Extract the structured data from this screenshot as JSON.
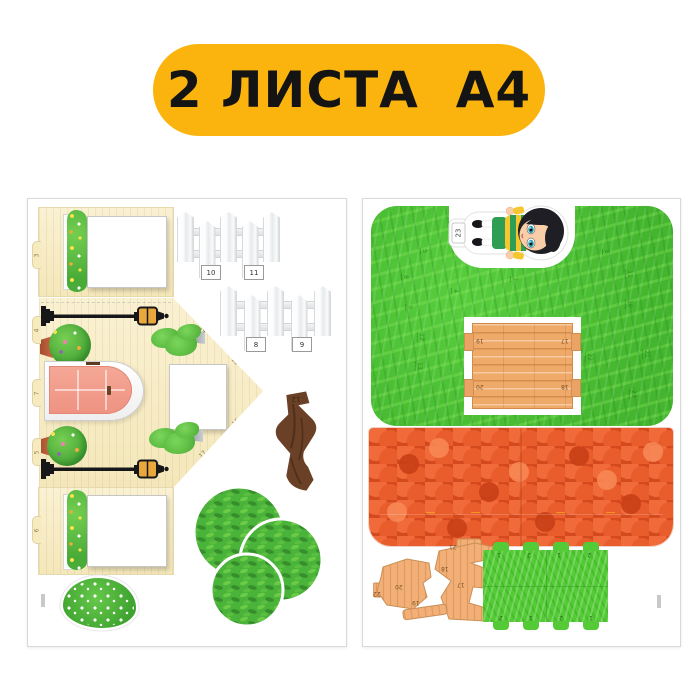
{
  "badge": {
    "label": "2 ЛИСТА  А4",
    "bg_color": "#FBB30D",
    "text_color": "#141414"
  },
  "palette": {
    "wall_cream": "#F8EDC6",
    "door_pink": "#F29A8B",
    "grass_green": "#4EC336",
    "roof_orange": "#E85A2B",
    "wood_tan": "#EFAA6A",
    "foliage_green": "#4AB33A",
    "lantern_amber": "#E9A83C",
    "trunk_brown": "#6A4026"
  },
  "sheet_left": {
    "edge_tabs": [
      {
        "label": "3"
      },
      {
        "label": "4"
      },
      {
        "label": "7"
      },
      {
        "label": "5"
      },
      {
        "label": "6"
      }
    ],
    "gable_tabs": [
      {
        "label": "14"
      },
      {
        "label": "15"
      },
      {
        "label": "16"
      },
      {
        "label": "17"
      }
    ],
    "fence_top_labels": [
      {
        "label": "10"
      },
      {
        "label": "11"
      }
    ],
    "fence_bottom_labels": [
      {
        "label": "8"
      },
      {
        "label": "9"
      }
    ],
    "trunk_label": "12"
  },
  "sheet_right": {
    "boy_tab_label": "23",
    "table_tabs": [
      {
        "label": "19"
      },
      {
        "label": "17"
      },
      {
        "label": "20"
      },
      {
        "label": "18"
      }
    ],
    "grass_fold_labels": [
      {
        "label": "5"
      },
      {
        "label": "8"
      },
      {
        "label": "4"
      },
      {
        "label": "9"
      },
      {
        "label": "12"
      },
      {
        "label": "13"
      },
      {
        "label": "7"
      },
      {
        "label": "6"
      },
      {
        "label": "11"
      },
      {
        "label": "10"
      },
      {
        "label": "22"
      },
      {
        "label": "21"
      },
      {
        "label": "23"
      }
    ],
    "wood_labels": [
      {
        "label": "21"
      },
      {
        "label": "18"
      },
      {
        "label": "17"
      },
      {
        "label": "20"
      },
      {
        "label": "19"
      },
      {
        "label": "22"
      }
    ],
    "strip_top_tabs": [
      {
        "label": "1"
      },
      {
        "label": "2"
      },
      {
        "label": "1"
      },
      {
        "label": "2"
      }
    ],
    "strip_bottom_tabs": [
      {
        "label": "2"
      },
      {
        "label": "1"
      },
      {
        "label": "2"
      },
      {
        "label": "1"
      }
    ]
  }
}
